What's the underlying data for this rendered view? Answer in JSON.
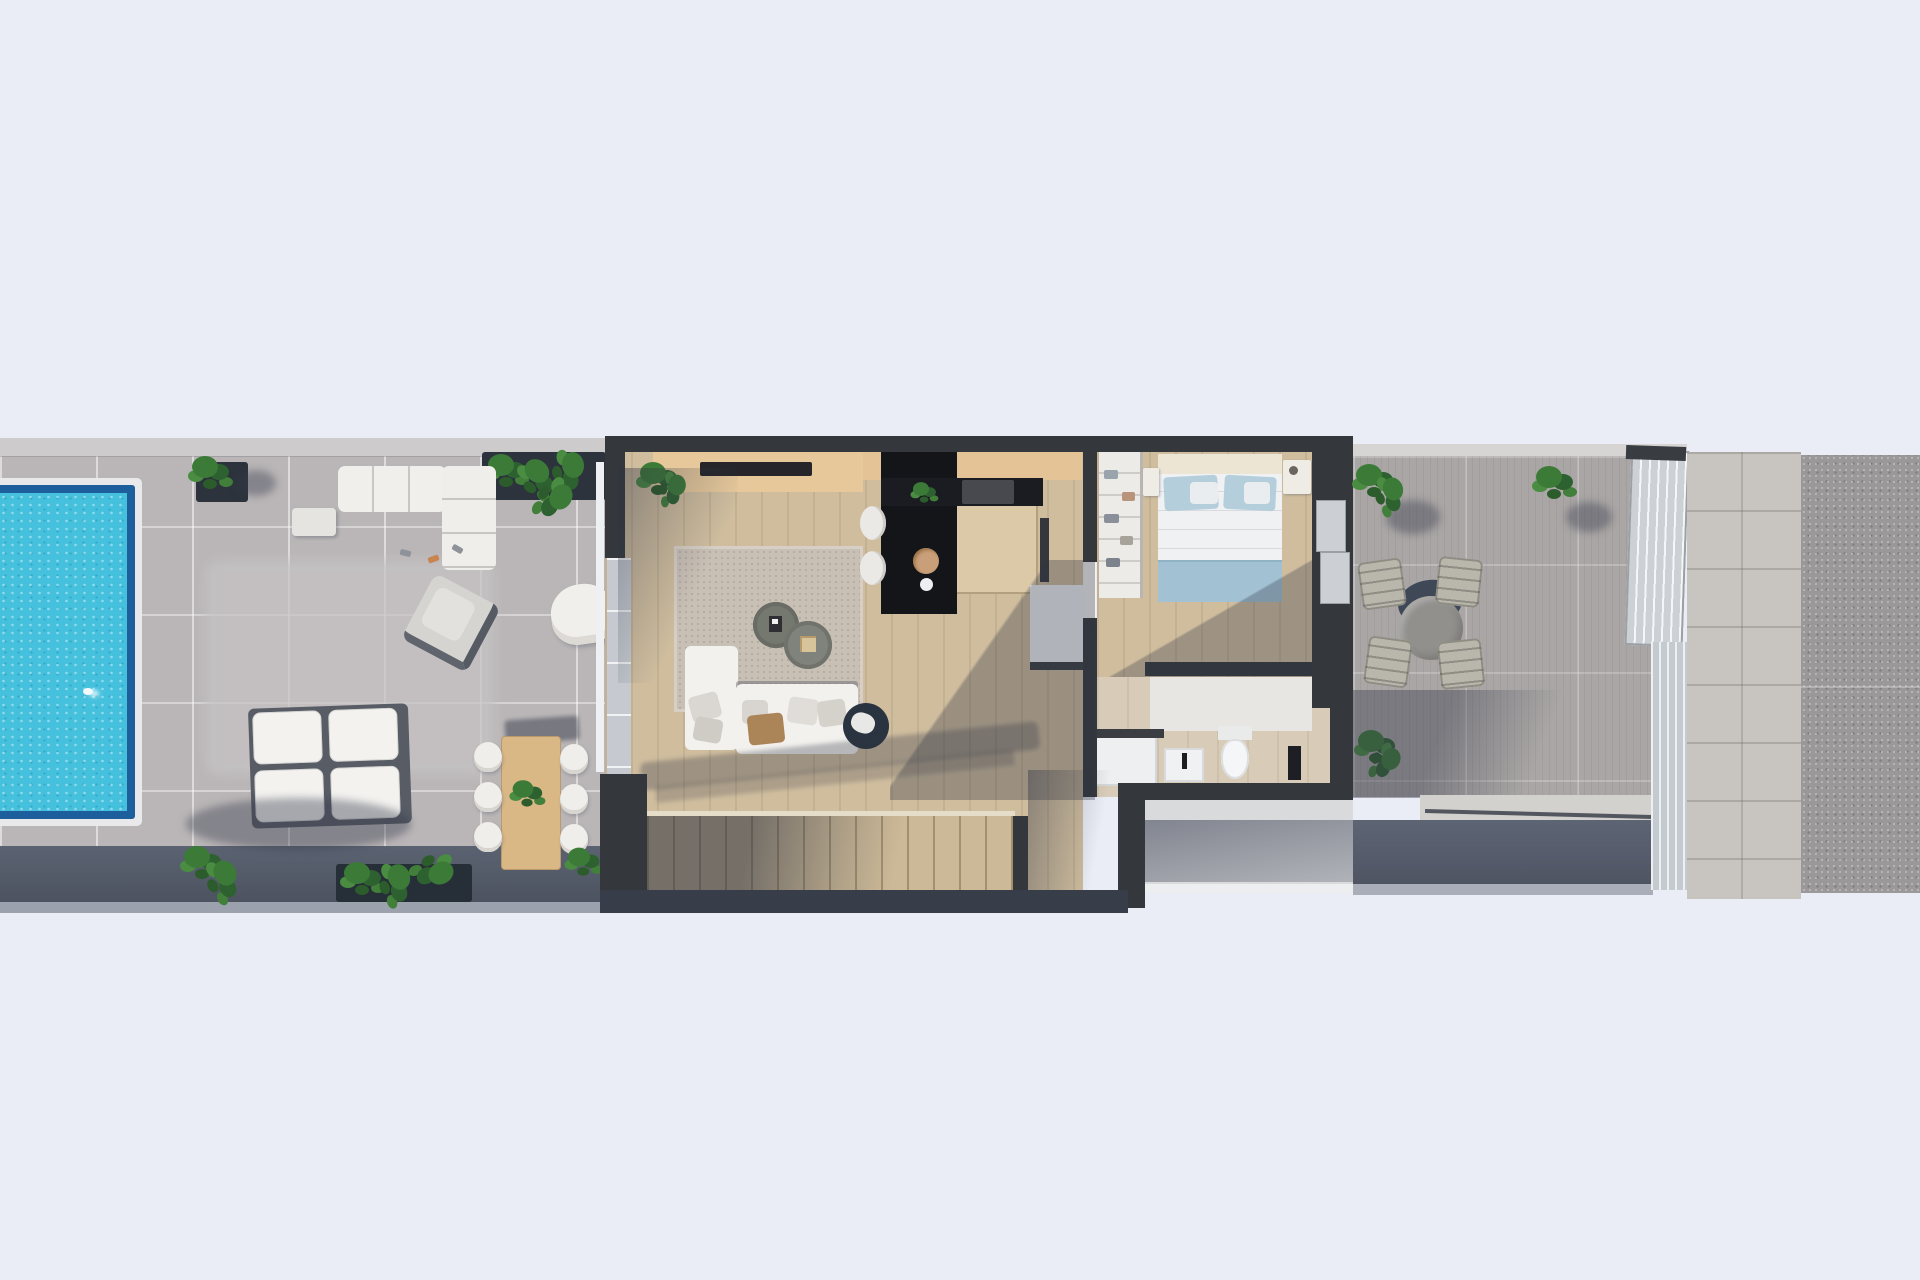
{
  "meta": {
    "content_type": "architectural-3d-floorplan-render",
    "view": "top-down",
    "visible_text": "none"
  },
  "palette": {
    "background": "#eaedf6",
    "left_terrace_tile": "#bab6b7",
    "terrace_edge_band": "#cdcbcc",
    "terrace_wall_shadow_band": "#555d6c",
    "pool_water": "#45c1de",
    "pool_border": "#1d5f9c",
    "pool_rim": "#e9e9ec",
    "house_wall": "#34373c",
    "wood_floor": "#cfbd9e",
    "sideboard": "#e6c89b",
    "tv": "#26262a",
    "kitchen_counter": "#141519",
    "kitchen_island": "#dbc9a8",
    "rug": "#c9c0b5",
    "sofa": "#f2f1ed",
    "accent_chair_navy": "#2a3440",
    "bed_duvet": "#f0f1f3",
    "bed_pillows": "#b5cedc",
    "bed_throw": "#a2c1d2",
    "bath_fixtures": "#f0f1f2",
    "stairs": "#ccb997",
    "right_terrace_tile": "#aaa6a5",
    "outdoor_table": "#92908d",
    "outdoor_chairs": "#b9b6ab",
    "wood_dining_table": "#d9b886",
    "plants": "#3c7a38",
    "planter": "#2c333c",
    "stone_path": "#c8c5c0",
    "aggregate_strip": "#9b9899",
    "patio": "#d9dadc"
  },
  "scene": {
    "areas": [
      {
        "name": "pool",
        "features": [
          "turquoise-water",
          "dark-blue-border",
          "white-rim",
          "sparkle-highlight"
        ]
      },
      {
        "name": "left-terrace",
        "features": [
          "tile-grid",
          "hedge-planters",
          "potted-plants",
          "outdoor-lounge-sofa",
          "gray-armchair",
          "white-armchair",
          "double-sunloungers",
          "wood-dining-table-6-chairs"
        ]
      },
      {
        "name": "house-interior",
        "rooms": [
          "living-room",
          "kitchen",
          "hallway",
          "bedroom",
          "bathroom",
          "staircase"
        ]
      },
      {
        "name": "living-room",
        "features": [
          "rug",
          "l-shaped-sofa",
          "two-round-coffee-tables",
          "navy-swivel-chair",
          "sideboard",
          "tv-bar",
          "corner-plant"
        ]
      },
      {
        "name": "kitchen",
        "features": [
          "black-l-counter",
          "wood-island",
          "two-bar-stools",
          "round-sink",
          "counter-plant",
          "appliance"
        ]
      },
      {
        "name": "bedroom",
        "features": [
          "double-bed-blue-bedding",
          "wardrobe-shelves",
          "nightstands",
          "sliding-glass-door"
        ]
      },
      {
        "name": "bathroom",
        "features": [
          "shower-tray",
          "sink",
          "toilet",
          "towel-stand"
        ]
      },
      {
        "name": "staircase",
        "features": [
          "straight-run-steps",
          "handrail-line",
          "diagonal-shadow"
        ]
      },
      {
        "name": "right-terrace",
        "features": [
          "round-dining-table",
          "four-chairs",
          "three-plants",
          "glass-door",
          "glass-fence"
        ]
      },
      {
        "name": "walkway",
        "features": [
          "stone-path"
        ]
      },
      {
        "name": "aggregate-strip",
        "features": [
          "speckled-gravel"
        ]
      }
    ]
  }
}
